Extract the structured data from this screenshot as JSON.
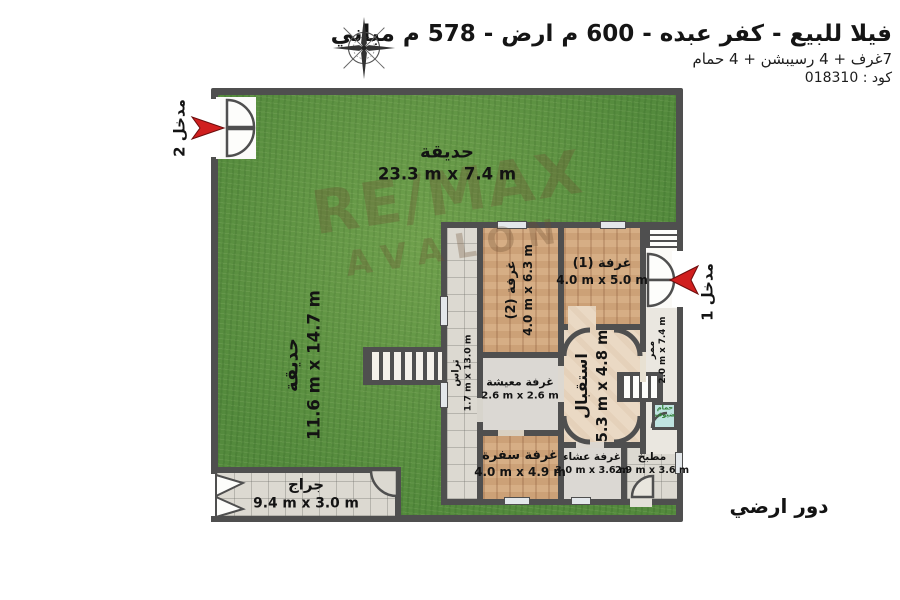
{
  "header": {
    "title": "فيلا للبيع - كفر عبده - 600 م ارض - 578 م مباني",
    "subtitle": "7غرف + 4 رسيبشن + 4 حمام",
    "code_label": "كود : 018310"
  },
  "floor_label": "دور ارضي",
  "watermark": {
    "line1": "RE/MAX",
    "line2": "AVALON"
  },
  "entrances": {
    "e1": {
      "label": "مدخل 1"
    },
    "e2": {
      "label": "مدخل 2"
    }
  },
  "areas": {
    "garden_top": {
      "name": "حديقة",
      "dims": "23.3 m x 7.4 m"
    },
    "garden_left": {
      "name": "حديقة",
      "dims": "11.6 m x 14.7 m"
    },
    "room1": {
      "name": "غرفة (1)",
      "dims": "4.0 m x 5.0 m"
    },
    "room2": {
      "name": "غرفة (2)",
      "dims": "4.0 m x 6.3 m"
    },
    "reception": {
      "name": "استقبال",
      "dims": "5.3 m x 4.8 m"
    },
    "living": {
      "name": "غرفة معيشة",
      "dims": "2.6 m x 2.6 m"
    },
    "dining": {
      "name": "غرفة سفرة",
      "dims": "4.0 m x 4.9 m"
    },
    "dinner": {
      "name": "غرفة عشاء",
      "dims": "3.0 m x 3.6 m"
    },
    "kitchen": {
      "name": "مطبخ",
      "dims": "2.9 m x 3.6 m"
    },
    "corridor": {
      "name": "ممر",
      "dims": "2.0 m x 7.4 m"
    },
    "terrace": {
      "name": "تراس",
      "dims": "1.7 m x 13.0 m"
    },
    "garage": {
      "name": "جراج",
      "dims": "9.4 m x 3.0 m"
    },
    "guest_bath": {
      "name": "حمام ضيوف"
    }
  },
  "colors": {
    "wall": "#4f4f4f",
    "grass": "#5a9141",
    "wood": "#d2a87e",
    "tile": "#dcd9d1",
    "hall": "#ead9c4",
    "bath": "#bfe3e0",
    "arrow": "#d01f1f",
    "ink": "#151515"
  }
}
